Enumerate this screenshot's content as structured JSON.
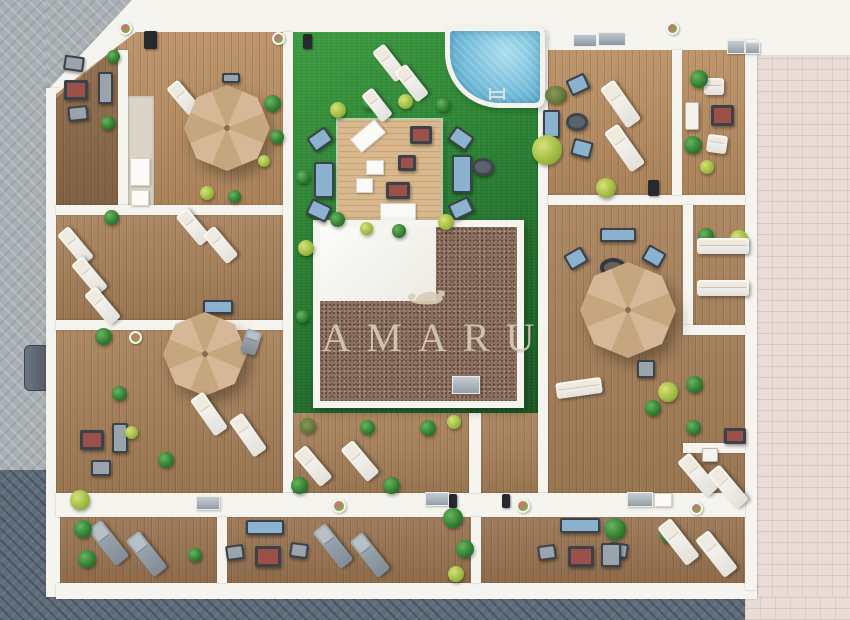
{
  "scene": {
    "kind": "architectural-aerial-3d-render",
    "description": "Top-down render of rooftop/courtyard terraces: wooden deck terraces with parasols, loungers and lounge sets around a central lawn courtyard with pool, timber platform and pebble-roofed core building",
    "watermark": {
      "text": "AMARU",
      "logo": "reclining-monkey"
    },
    "palette": {
      "white_structure": "#f5f4ef",
      "lawn_light": "#3f9d42",
      "lawn": "#2c8134",
      "lawn_dark": "#1b5a26",
      "deck": "#a8815a",
      "deck_light": "#ba8f63",
      "deck_dark": "#8c6a49",
      "deck_deep": "#9a7552",
      "platform_wood": "#d8b88c",
      "pebble": "#8c7160",
      "pool_water": "#6fb9d8",
      "pool_light": "#a9ddec",
      "umbrella": "#d7b896",
      "umbrella_dark": "#c5a67f",
      "street_gray": "#a9b0b4",
      "street_dark": "#5d6b7a",
      "street_pink": "#e9dbd6",
      "cushion_blue": "#8bb2ce",
      "furniture_dark": "#3c4249",
      "furniture_gray": "#99a4ac",
      "table_red": "#9d5047",
      "plant_green": "#2f7c31",
      "plant_dark": "#1d5423",
      "plant_yellow": "#9cb93f",
      "watermark": "#d8cdb7"
    }
  }
}
